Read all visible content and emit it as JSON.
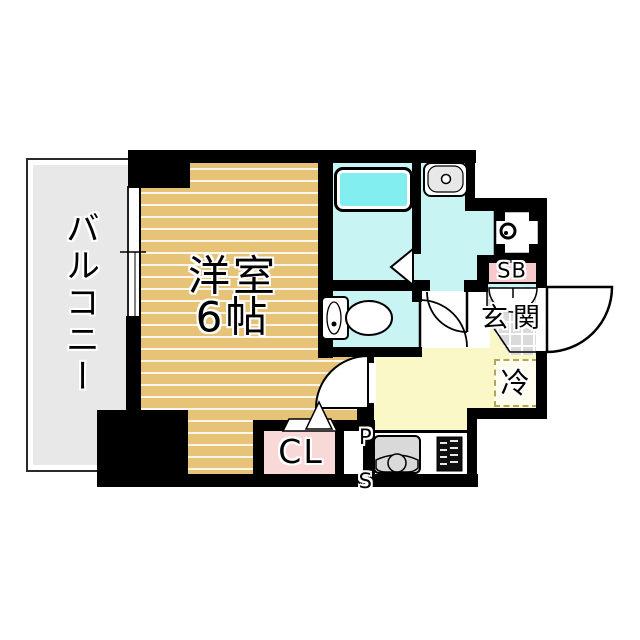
{
  "plan": {
    "labels": {
      "balcony": "バルコニー",
      "room": "洋室",
      "room_size": "6帖",
      "entrance": "玄関",
      "shoe_box": "SB",
      "refrigerator": "冷",
      "closet": "CL",
      "pipe_space_p": "P",
      "pipe_space_s": "S"
    },
    "colors": {
      "wall": "#000000",
      "flooring": "#e7c378",
      "wet_area": "#c9f4f4",
      "bathtub": "#82eef0",
      "hall": "#fbf8c8",
      "closet_pink": "#f9d8d8",
      "shoe_box_pink": "#f6caca",
      "balcony_gray": "#e8e8e8",
      "entrance_tile": "#dadada",
      "refrigerator_dash": "#b3a55b"
    },
    "fixtures": [
      "bathtub",
      "wash-basin",
      "washing-machine",
      "toilet",
      "kitchen-sink",
      "gas-stove",
      "window",
      "entrance-door",
      "room-door",
      "toilet-door",
      "washroom-door",
      "shoe-box-doors"
    ]
  }
}
